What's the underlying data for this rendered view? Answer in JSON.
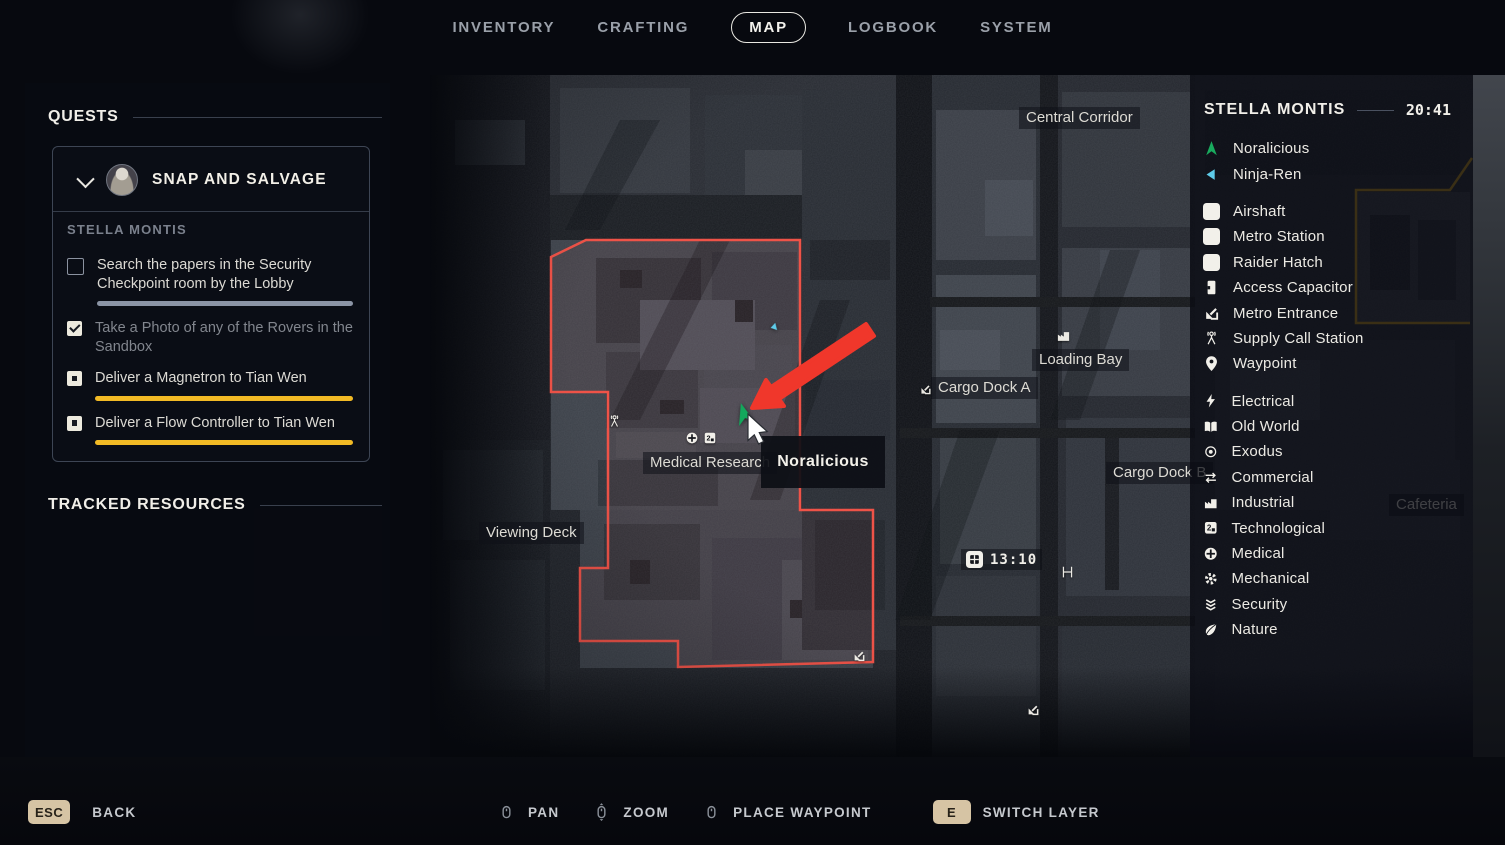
{
  "nav": {
    "items": [
      {
        "label": "INVENTORY",
        "active": false
      },
      {
        "label": "CRAFTING",
        "active": false
      },
      {
        "label": "MAP",
        "active": true
      },
      {
        "label": "LOGBOOK",
        "active": false
      },
      {
        "label": "SYSTEM",
        "active": false
      }
    ]
  },
  "quests": {
    "section_title": "QUESTS",
    "card": {
      "title": "SNAP AND SALVAGE",
      "location": "STELLA MONTIS",
      "objectives": [
        {
          "text": "Search the papers in the Security Checkpoint room by the Lobby",
          "state": "empty",
          "bar": "gray"
        },
        {
          "text": "Take a Photo of any of the Rovers in the Sandbox",
          "state": "checked",
          "bar": null
        },
        {
          "text": "Deliver a Magnetron to Tian Wen",
          "state": "dot",
          "bar": "yellow"
        },
        {
          "text": "Deliver a Flow Controller to Tian Wen",
          "state": "dot",
          "bar": "yellow"
        }
      ]
    },
    "tracked_title": "TRACKED RESOURCES"
  },
  "legend": {
    "title": "STELLA MONTIS",
    "time": "20:41",
    "groups": [
      {
        "items": [
          {
            "icon": "player",
            "label": "Noralicious",
            "color": "#19ab5e"
          },
          {
            "icon": "tri-left",
            "label": "Ninja-Ren",
            "color": "#5ecbe9"
          }
        ]
      },
      {
        "items": [
          {
            "icon": "fan",
            "label": "Airshaft",
            "boxed": true
          },
          {
            "icon": "grid",
            "label": "Metro Station",
            "boxed": true
          },
          {
            "icon": "hatch",
            "label": "Raider Hatch",
            "boxed": true
          },
          {
            "icon": "door",
            "label": "Access Capacitor"
          },
          {
            "icon": "corner-arrow",
            "label": "Metro Entrance"
          },
          {
            "icon": "antenna",
            "label": "Supply Call Station"
          },
          {
            "icon": "pin",
            "label": "Waypoint"
          }
        ]
      },
      {
        "items": [
          {
            "icon": "bolt",
            "label": "Electrical"
          },
          {
            "icon": "book",
            "label": "Old World"
          },
          {
            "icon": "eye",
            "label": "Exodus"
          },
          {
            "icon": "exchange",
            "label": "Commercial"
          },
          {
            "icon": "factory",
            "label": "Industrial"
          },
          {
            "icon": "chip2",
            "label": "Technological"
          },
          {
            "icon": "medcross",
            "label": "Medical"
          },
          {
            "icon": "gear",
            "label": "Mechanical"
          },
          {
            "icon": "chevrons",
            "label": "Security"
          },
          {
            "icon": "leaf",
            "label": "Nature"
          }
        ]
      }
    ]
  },
  "map": {
    "labels": [
      {
        "text": "Central Corridor",
        "x": 1019,
        "y": 107
      },
      {
        "text": "Loading Bay",
        "x": 1032,
        "y": 349
      },
      {
        "text": "Cargo Dock A",
        "x": 931,
        "y": 377
      },
      {
        "text": "Cargo Dock B",
        "x": 1106,
        "y": 462
      },
      {
        "text": "Medical Research",
        "x": 643,
        "y": 452
      },
      {
        "text": "Viewing Deck",
        "x": 479,
        "y": 522
      },
      {
        "text": "Cafeteria",
        "x": 1389,
        "y": 494
      }
    ],
    "icons": [
      {
        "icon": "factory",
        "x": 1056,
        "y": 328,
        "s": 15
      },
      {
        "icon": "corner-arrow",
        "x": 919,
        "y": 383,
        "s": 13
      },
      {
        "icon": "antenna",
        "x": 607,
        "y": 414,
        "s": 15
      },
      {
        "icon": "medcross",
        "x": 685,
        "y": 431,
        "s": 14
      },
      {
        "icon": "chip2",
        "x": 703,
        "y": 431,
        "s": 14
      },
      {
        "icon": "corner-arrow",
        "x": 852,
        "y": 649,
        "s": 14
      },
      {
        "icon": "corner-arrow",
        "x": 1026,
        "y": 703,
        "s": 14
      },
      {
        "icon": "hbeam",
        "x": 1060,
        "y": 551,
        "s": 15,
        "h": 42
      }
    ],
    "markers": [
      {
        "icon": "player",
        "name": "noralicious-marker",
        "x": 731,
        "y": 401,
        "s": 26,
        "rot": -16,
        "color": "#13a85c"
      },
      {
        "icon": "tri-left",
        "name": "ninja-ren-marker",
        "x": 768,
        "y": 321,
        "s": 12,
        "rot": -14,
        "color": "#5ecbe9"
      }
    ],
    "tooltip": "Noralicious",
    "time_badge": "13:10"
  },
  "footer": {
    "back_key": "ESC",
    "back_label": "BACK",
    "controls": [
      {
        "icon": "mouse",
        "label": "PAN"
      },
      {
        "icon": "mouse-wheel",
        "label": "ZOOM"
      },
      {
        "icon": "mouse",
        "label": "PLACE WAYPOINT"
      },
      {
        "key": "E",
        "label": "SWITCH LAYER"
      }
    ]
  },
  "colors": {
    "quest_region_outline": "#ef5348",
    "secondary_region_outline": "#c79a1f",
    "annotation_arrow": "#f0372b",
    "progress_yellow": "#f2ba25",
    "progress_gray": "#8b94a5",
    "player_marker_green": "#13a85c",
    "companion_marker_cyan": "#5ecbe9",
    "key_badge_tan": "#d6c4a4"
  }
}
